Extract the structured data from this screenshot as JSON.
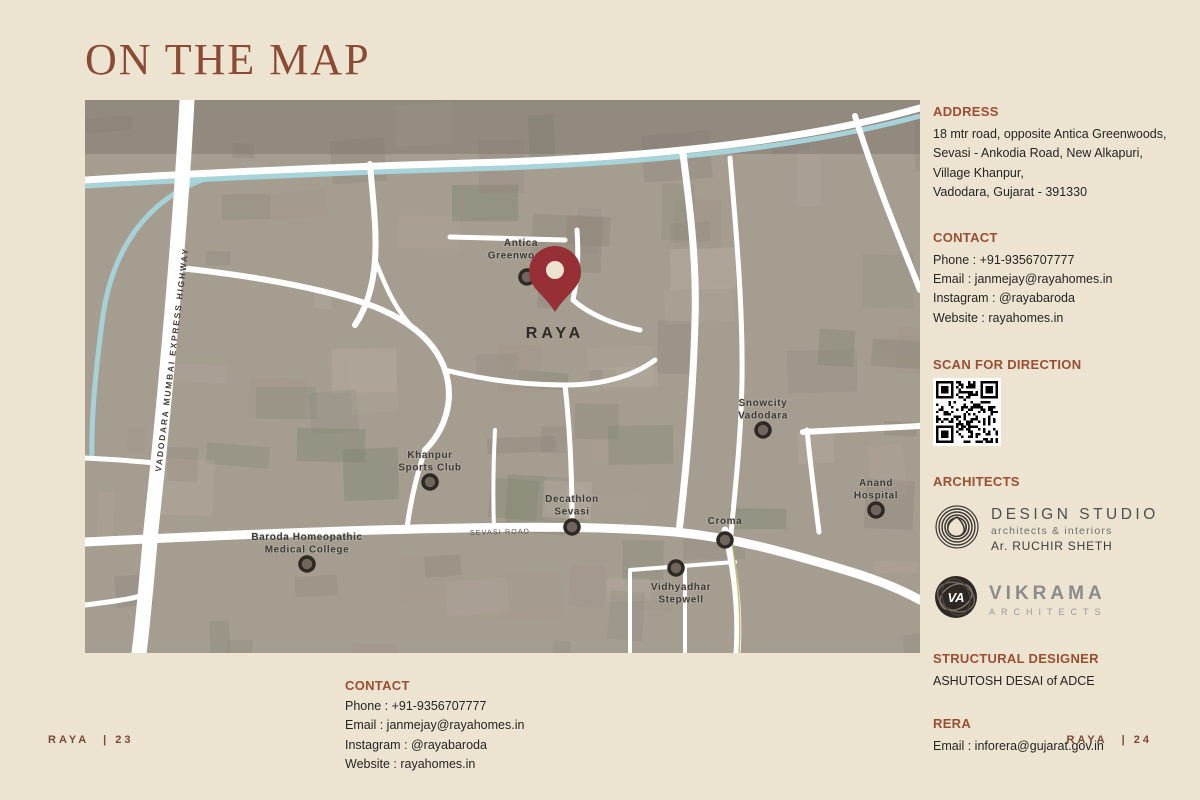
{
  "page": {
    "title": "ON THE MAP",
    "footer_left_brand": "RAYA",
    "footer_left_page": "| 23",
    "footer_right_brand": "RAYA",
    "footer_right_page": "| 24"
  },
  "colors": {
    "background": "#ece3d1",
    "title": "#8a4a33",
    "heading": "#9a4f33",
    "body_text": "#262523",
    "pin": "#963036",
    "canal": "#a6d7de",
    "road": "#ffffff",
    "map_base": "#a69d91"
  },
  "map": {
    "project_label": "RAYA",
    "highway_label": "VADODARA MUMBAI EXPRESS HIGHWAY",
    "road_label": "SEVASI ROAD",
    "pois": [
      {
        "lines": [
          "Antica",
          "Greenwoods"
        ],
        "dot": [
          442,
          177
        ],
        "label": [
          436,
          146
        ],
        "label_below": false
      },
      {
        "lines": [
          "Khanpur",
          "Sports Club"
        ],
        "dot": [
          345,
          382
        ],
        "label": [
          345,
          358
        ],
        "label_below": false
      },
      {
        "lines": [
          "Decathlon",
          "Sevasi"
        ],
        "dot": [
          487,
          427
        ],
        "label": [
          487,
          402
        ],
        "label_below": false
      },
      {
        "lines": [
          "Snowcity",
          "Vadodara"
        ],
        "dot": [
          678,
          330
        ],
        "label": [
          678,
          306
        ],
        "label_below": false
      },
      {
        "lines": [
          "Anand",
          "Hospital"
        ],
        "dot": [
          791,
          410
        ],
        "label": [
          791,
          386
        ],
        "label_below": false
      },
      {
        "lines": [
          "Croma"
        ],
        "dot": [
          640,
          440
        ],
        "label": [
          640,
          424
        ],
        "label_below": false
      },
      {
        "lines": [
          "Vidhyadhar",
          "Stepwell"
        ],
        "dot": [
          591,
          468
        ],
        "label": [
          596,
          490
        ],
        "label_below": true
      },
      {
        "lines": [
          "Baroda Homeopathic",
          "Medical College"
        ],
        "dot": [
          222,
          464
        ],
        "label": [
          222,
          440
        ],
        "label_below": false
      }
    ]
  },
  "sidebar": {
    "address": {
      "heading": "ADDRESS",
      "lines": [
        "18 mtr road, opposite Antica Greenwoods,",
        "Sevasi - Ankodia Road, New Alkapuri,",
        "Village Khanpur,",
        "Vadodara, Gujarat - 391330"
      ]
    },
    "contact": {
      "heading": "CONTACT",
      "lines": [
        "Phone : +91-9356707777",
        "Email : janmejay@rayahomes.in",
        "Instagram : @rayabaroda",
        "Website : rayahomes.in"
      ]
    },
    "scan": {
      "heading": "SCAN FOR DIRECTION"
    },
    "architects": {
      "heading": "ARCHITECTS",
      "design_studio": {
        "name": "DESIGN STUDIO",
        "subtitle": "architects & interiors",
        "person": "Ar. RUCHIR SHETH"
      },
      "vikrama": {
        "name": "VIKRAMA",
        "subtitle": "ARCHITECTS",
        "monogram": "VA"
      }
    },
    "structural": {
      "heading": "STRUCTURAL DESIGNER",
      "value": "ASHUTOSH DESAI of ADCE"
    },
    "rera": {
      "heading": "RERA",
      "value": "Email : inforera@gujarat.gov.in"
    }
  },
  "bottom_contact": {
    "heading": "CONTACT",
    "lines": [
      "Phone : +91-9356707777",
      "Email : janmejay@rayahomes.in",
      "Instagram : @rayabaroda",
      "Website : rayahomes.in"
    ]
  }
}
